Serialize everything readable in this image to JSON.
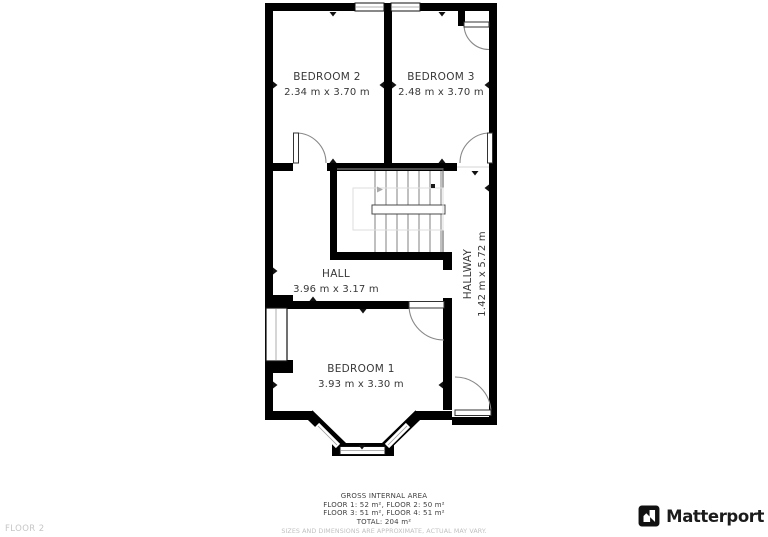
{
  "plan": {
    "rooms": [
      {
        "name": "BEDROOM 2",
        "dims": "2.34 m x 3.70 m"
      },
      {
        "name": "BEDROOM 3",
        "dims": "2.48 m x 3.70 m"
      },
      {
        "name": "HALL",
        "dims": "3.96 m x 3.17 m"
      },
      {
        "name": "HALLWAY",
        "dims": "1.42 m x 5.72 m"
      },
      {
        "name": "BEDROOM 1",
        "dims": "3.93 m x 3.30 m"
      }
    ]
  },
  "footer": {
    "title": "GROSS INTERNAL AREA",
    "line1": "FLOOR 1: 52 m², FLOOR 2: 50 m²",
    "line2": "FLOOR 3: 51 m², FLOOR 4: 51 m²",
    "total": "TOTAL: 204 m²",
    "disclaimer": "SIZES AND DIMENSIONS ARE APPROXIMATE, ACTUAL MAY VARY."
  },
  "floor_label": "FLOOR 2",
  "brand": {
    "name": "Matterport"
  },
  "colors": {
    "walls": "#000000",
    "background": "#ffffff",
    "room_text": "#383838",
    "stair_lines": "#8d8d8d",
    "door_arcs": "#888888",
    "footer_text": "#3f3f3f",
    "muted_text": "#c0c0c0",
    "brand_text": "#1c1c1c"
  }
}
